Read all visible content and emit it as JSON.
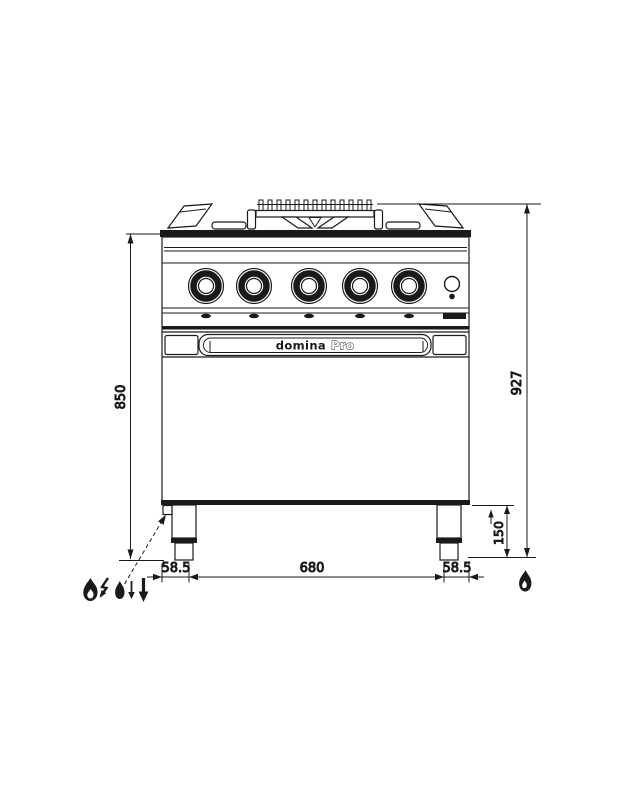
{
  "diagram": {
    "brand": {
      "name": "domina",
      "suffix": "Pro"
    },
    "dimensions": {
      "hob_height_mm": "850",
      "total_height_mm": "927",
      "plinth_height_mm": "150",
      "leg_span_mm": "680",
      "left_leg_offset_mm": "58.5",
      "right_leg_offset_mm": "58.5"
    },
    "icons": {
      "connection_legend": [
        "gas-flame",
        "electric-bolt-down-arrow",
        "water-drop",
        "arrow-down-thin",
        "arrow-down-bold"
      ],
      "gas_connection_point": "gas-flame"
    },
    "colors": {
      "line": "#1a1a1a",
      "background": "#ffffff"
    }
  }
}
